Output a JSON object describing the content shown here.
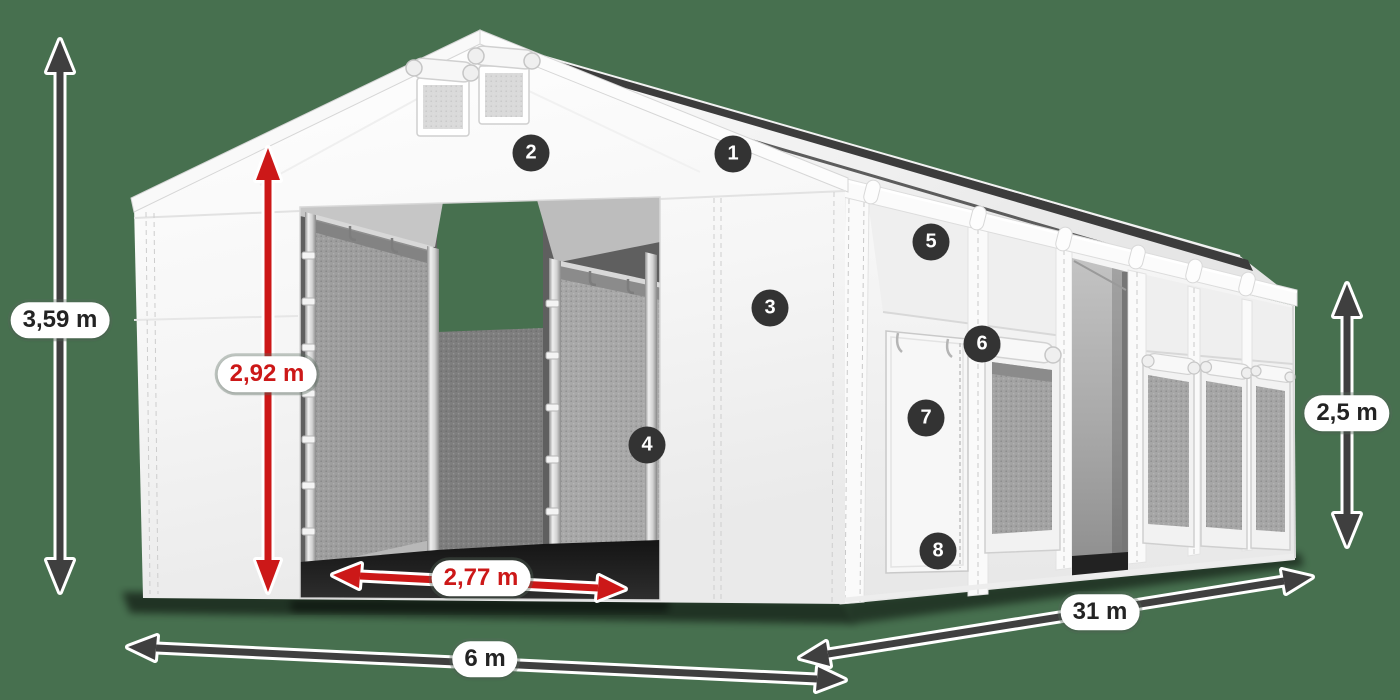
{
  "colors": {
    "background": "#47704f",
    "accent_red": "#cc1818",
    "arrow_dark": "#3f3f3f",
    "badge_bg": "#333333",
    "pill_bg": "#ffffff",
    "pill_text": "#232323"
  },
  "dimension_labels": {
    "total_height": "3,59 m",
    "entrance_height": "2,92 m",
    "entrance_width": "2,77 m",
    "side_height": "2,5 m",
    "width": "6 m",
    "length": "31 m"
  },
  "callouts": [
    {
      "number": "1"
    },
    {
      "number": "2"
    },
    {
      "number": "3"
    },
    {
      "number": "4"
    },
    {
      "number": "5"
    },
    {
      "number": "6"
    },
    {
      "number": "7"
    },
    {
      "number": "8"
    }
  ]
}
